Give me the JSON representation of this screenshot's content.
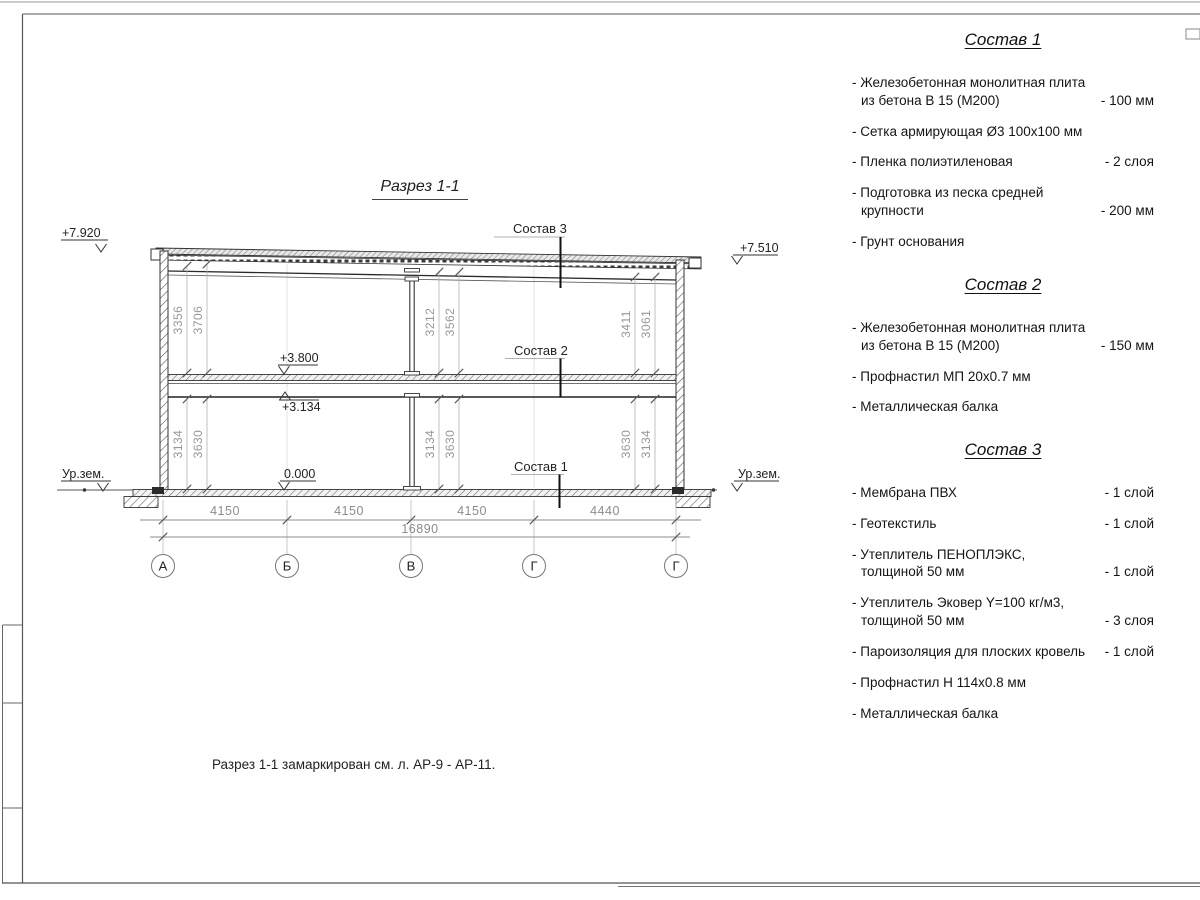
{
  "drawing": {
    "title": "Разрез 1-1",
    "elevations": {
      "roof_left": "+7.920",
      "roof_right": "+7.510",
      "floor_top": "+3.800",
      "floor_bottom": "+3.134",
      "ground": "0.000",
      "ground_level_left": "Ур.зем.",
      "ground_level_right": "Ур.зем."
    },
    "labels": {
      "s1": "Состав 1",
      "s2": "Состав 2",
      "s3": "Состав 3"
    },
    "dims": {
      "upper_left": [
        "3356",
        "3706"
      ],
      "upper_mid": [
        "3212",
        "3562"
      ],
      "upper_right": [
        "3411",
        "3061"
      ],
      "lower_left": [
        "3134",
        "3630"
      ],
      "lower_mid": [
        "3134",
        "3630"
      ],
      "lower_right": [
        "3630",
        "3134"
      ],
      "spans": [
        "4150",
        "4150",
        "4150",
        "4440"
      ],
      "total": "16890"
    },
    "axes": [
      "А",
      "Б",
      "В",
      "Г",
      "Г"
    ]
  },
  "compositions": [
    {
      "title": "Состав 1",
      "items": [
        {
          "name": "- Железобетонная  монолитная плита\nиз бетона В 15 (М200)",
          "value": "- 100 мм"
        },
        {
          "name": "- Сетка армирующая Ø3 100x100 мм",
          "value": ""
        },
        {
          "name": "- Пленка полиэтиленовая",
          "value": "- 2 слоя"
        },
        {
          "name": "- Подготовка из песка средней\nкрупности",
          "value": "- 200 мм"
        },
        {
          "name": "- Грунт основания",
          "value": ""
        }
      ]
    },
    {
      "title": "Состав 2",
      "items": [
        {
          "name": "- Железобетонная  монолитная плита\nиз бетона В 15 (М200)",
          "value": "- 150 мм"
        },
        {
          "name": "- Профнастил МП 20х0.7 мм",
          "value": ""
        },
        {
          "name": "- Металлическая балка",
          "value": ""
        }
      ]
    },
    {
      "title": "Состав 3",
      "items": [
        {
          "name": "- Мембрана ПВХ",
          "value": "- 1 слой"
        },
        {
          "name": "- Геотекстиль",
          "value": "- 1 слой"
        },
        {
          "name": "- Утеплитель ПЕНОПЛЭКС,\nтолщиной 50 мм",
          "value": "- 1 слой"
        },
        {
          "name": "- Утеплитель Эковер Y=100 кг/м3,\nтолщиной 50 мм",
          "value": "- 3 слоя"
        },
        {
          "name": "- Пароизоляция для плоских кровель",
          "value": "- 1 слой"
        },
        {
          "name": "- Профнастил Н 114х0.8 мм",
          "value": ""
        },
        {
          "name": "- Металлическая балка",
          "value": ""
        }
      ]
    }
  ],
  "note": "Разрез 1-1 замаркирован см. л. АР-9 - АР-11."
}
